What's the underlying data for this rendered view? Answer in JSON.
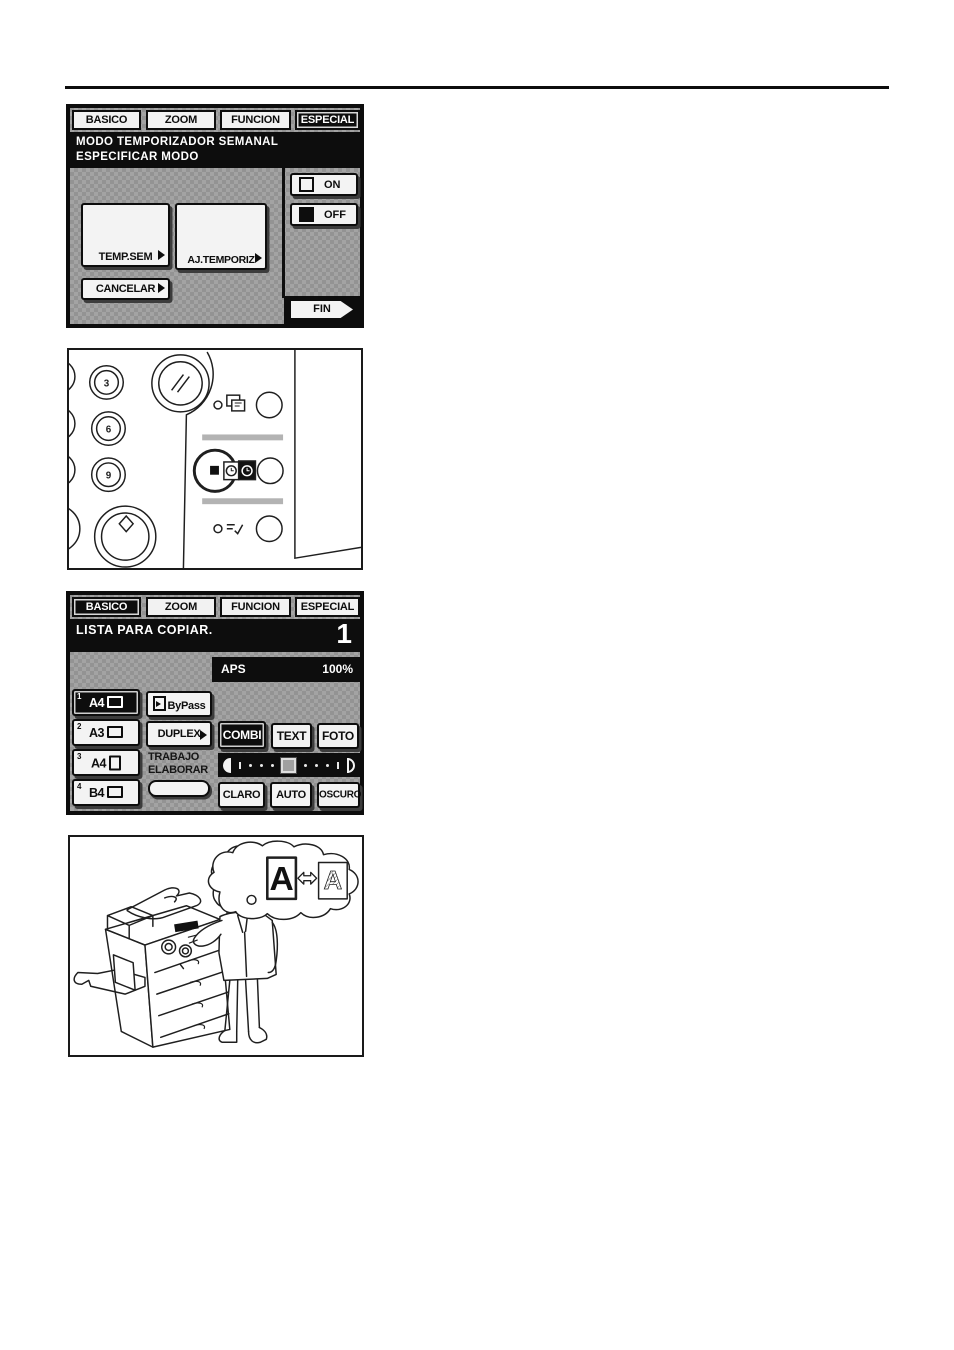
{
  "colors": {
    "lcd_bg": "#9b9b9b",
    "lcd_dark": "#0d0d0d",
    "button_face": "#f3f3f3"
  },
  "screen1": {
    "tabs": [
      {
        "label": "BASICO",
        "selected": false
      },
      {
        "label": "ZOOM",
        "selected": false
      },
      {
        "label": "FUNCION",
        "selected": false
      },
      {
        "label": "ESPECIAL",
        "selected": true
      }
    ],
    "message": {
      "line1": "MODO TEMPORIZADOR SEMANAL",
      "line2": "ESPECIFICAR MODO"
    },
    "toggle": {
      "on": "ON",
      "off": "OFF",
      "state": "OFF"
    },
    "buttons": {
      "temp_sem": "TEMP.SEM",
      "aj_temporiz": "AJ.TEMPORIZ",
      "cancelar": "CANCELAR",
      "fin": "FIN"
    }
  },
  "control_panel": {
    "keypad_digits": [
      "3",
      "6",
      "9"
    ],
    "icons": [
      "start-key-icon",
      "clear-all-key-icon",
      "interrupt-key-icon",
      "weekly-timer-key-icon",
      "energy-saver-key-icon"
    ],
    "highlighted_key": "weekly-timer-key"
  },
  "screen2": {
    "tabs": [
      {
        "label": "BASICO",
        "selected": true
      },
      {
        "label": "ZOOM",
        "selected": false
      },
      {
        "label": "FUNCION",
        "selected": false
      },
      {
        "label": "ESPECIAL",
        "selected": false
      }
    ],
    "status": "LISTA PARA COPIAR.",
    "copy_count": "1",
    "aps_label": "APS",
    "zoom_value": "100%",
    "trays": [
      {
        "num": "1",
        "size": "A4",
        "selected": true,
        "orientation": "landscape"
      },
      {
        "num": "2",
        "size": "A3",
        "selected": false,
        "orientation": "landscape"
      },
      {
        "num": "3",
        "size": "A4",
        "selected": false,
        "orientation": "portrait"
      },
      {
        "num": "4",
        "size": "B4",
        "selected": false,
        "orientation": "landscape"
      }
    ],
    "bypass_label": "ByPass",
    "duplex_label": "DUPLEX",
    "trabajo": {
      "line1": "TRABAJO",
      "line2": "ELABORAR"
    },
    "modes": [
      {
        "label": "COMBI",
        "selected": true
      },
      {
        "label": "TEXT",
        "selected": false
      },
      {
        "label": "FOTO",
        "selected": false
      }
    ],
    "density_buttons": [
      {
        "label": "CLARO"
      },
      {
        "label": "AUTO"
      },
      {
        "label": "OSCURO"
      }
    ]
  },
  "illustration": {
    "letter_left": "A",
    "letter_right": "A"
  }
}
